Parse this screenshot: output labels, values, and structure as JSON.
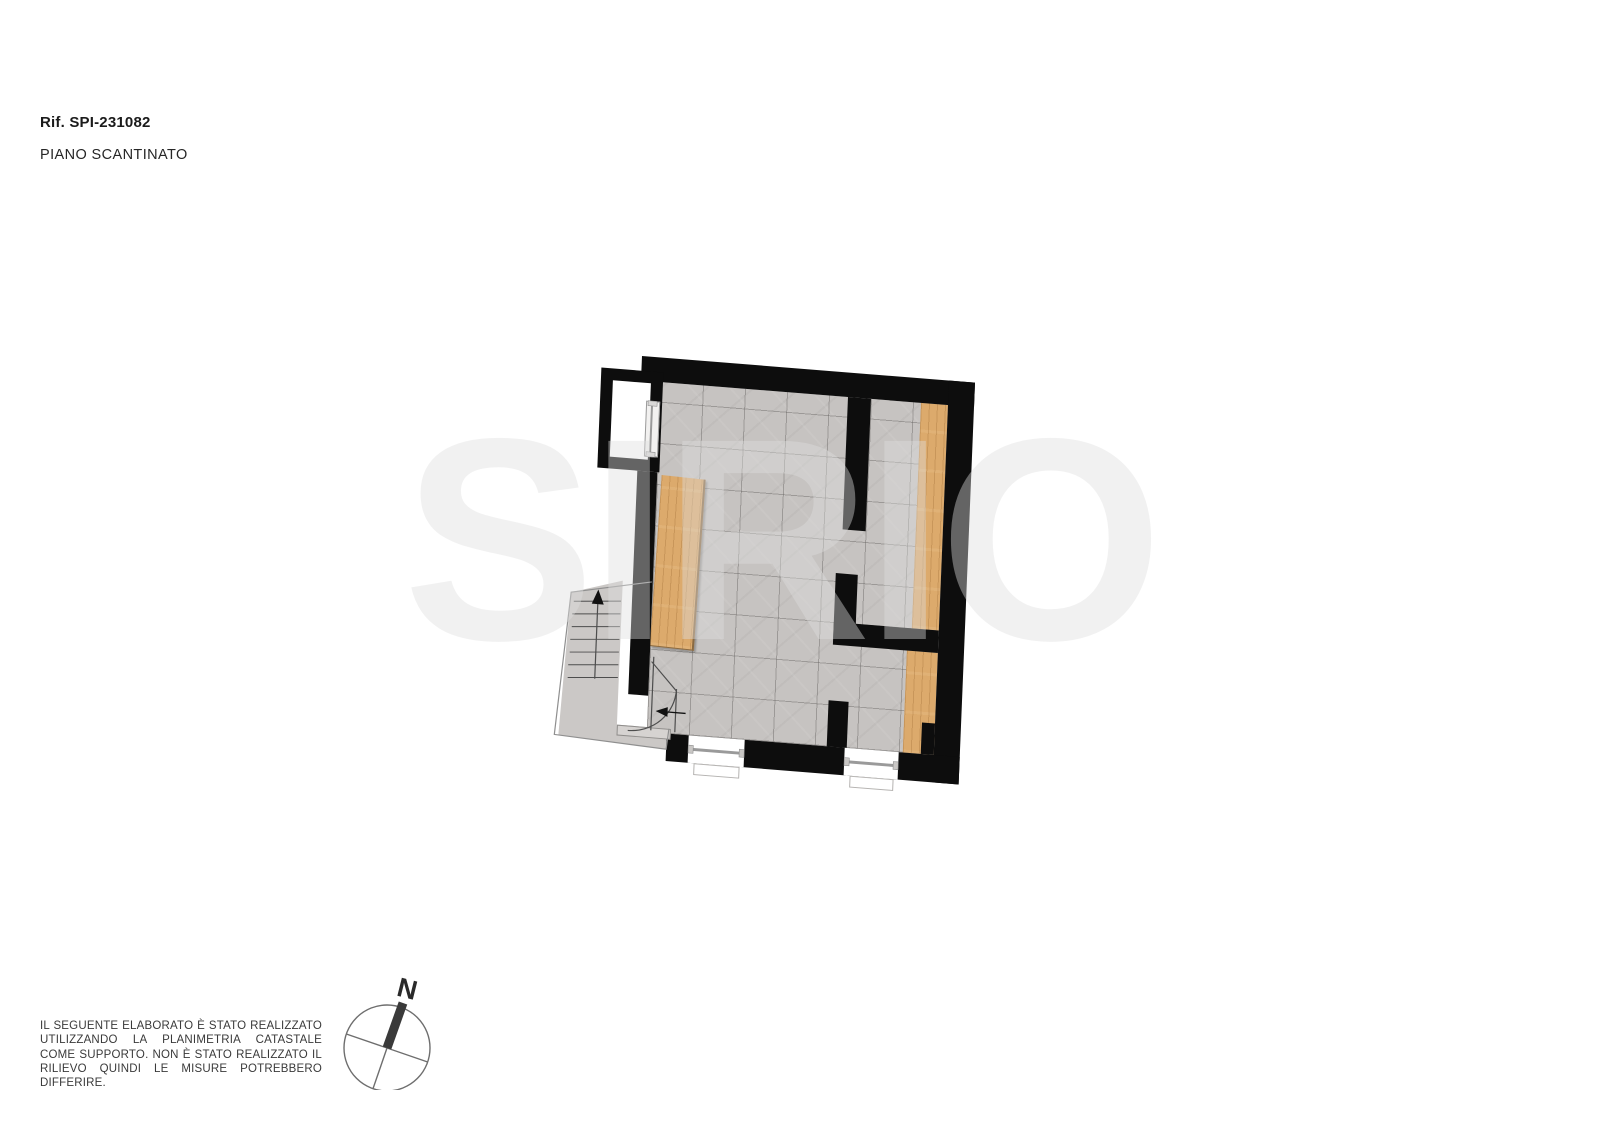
{
  "header": {
    "reference": "Rif. SPI-231082",
    "floor_label": "PIANO SCANTINATO"
  },
  "watermark": {
    "text": "SIRIO"
  },
  "compass": {
    "north_label": "N"
  },
  "disclaimer": {
    "text": "IL SEGUENTE ELABORATO È STATO REALIZZATO UTILIZZANDO LA PLANIMETRIA CATASTALE COME SUPPORTO. NON È STATO REALIZZATO IL RILIEVO QUINDI LE MISURE POTREBBERO DIFFERIRE."
  },
  "floor_plan": {
    "floor_name": "Piano scantinato (basement)",
    "colors": {
      "wall": "#0d0d0d",
      "tile": "#c6c3c1",
      "grout": "#a9a6a4",
      "wood": "#dcaa6c",
      "wood_grain": "#c08f52",
      "stairs": "#cbc8c6",
      "line": "#4d4d4d",
      "outline": "#8f8f8f",
      "window": "#ffffff",
      "threshold": "#d6d3d1"
    }
  }
}
